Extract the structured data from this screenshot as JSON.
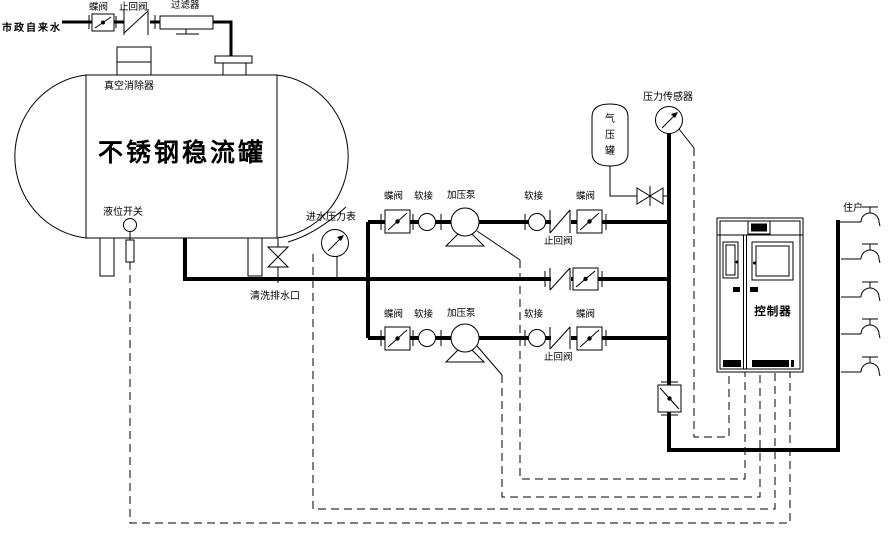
{
  "colors": {
    "ink": "#000000",
    "paper": "#ffffff"
  },
  "labels": {
    "city_water": "市政自来水",
    "butterfly_valve": "蝶阀",
    "check_valve": "止回阀",
    "filter": "过滤器",
    "vacuum_breaker": "真空消除器",
    "tank_title": "不锈钢稳流罐",
    "level_switch": "液位开关",
    "inlet_gauge": "进水压力表",
    "drain_port": "清洗排水口",
    "soft_joint": "软接",
    "booster_pump": "加压泵",
    "air_tank": "气压罐",
    "pressure_sensor": "压力传感器",
    "controller": "控制器",
    "users": "住户"
  }
}
